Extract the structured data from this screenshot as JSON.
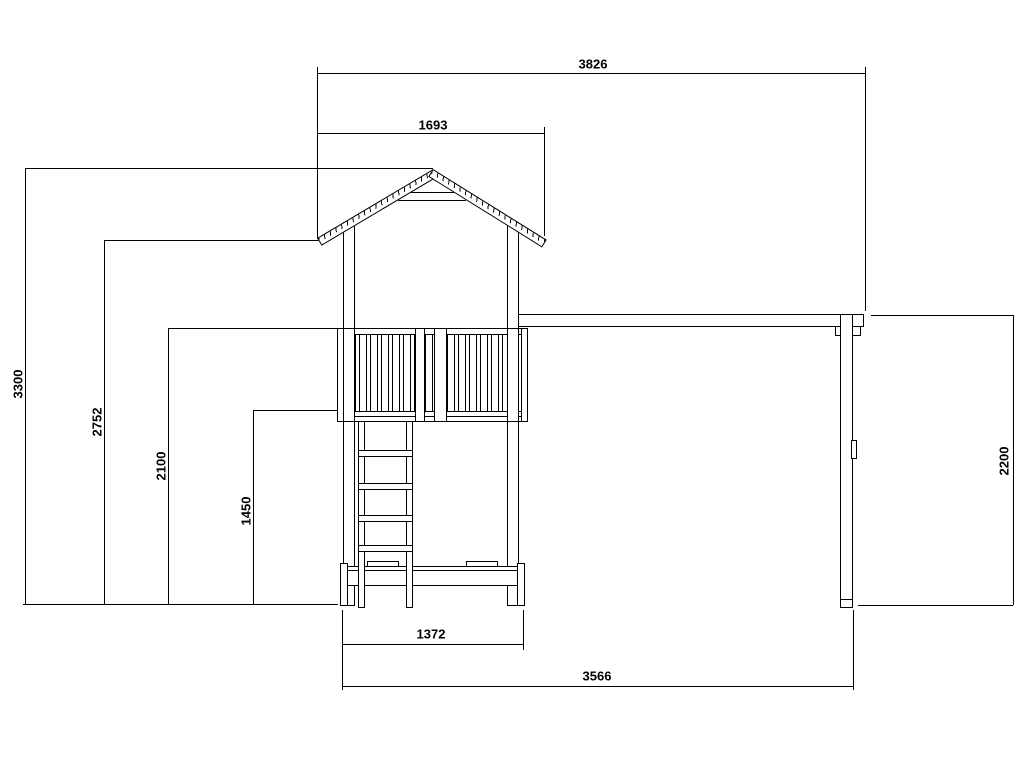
{
  "drawing": {
    "type": "technical-elevation",
    "subject": "play-tower-with-swing-beam",
    "line_color": "#000000",
    "background_color": "#ffffff"
  },
  "dims": {
    "overall_width": "3826",
    "roof_width": "1693",
    "total_height": "3300",
    "eave_height": "2752",
    "railing_height": "2100",
    "platform_height": "1450",
    "tower_base_width": "1372",
    "footprint_width": "3566",
    "swing_frame_height": "2200"
  }
}
